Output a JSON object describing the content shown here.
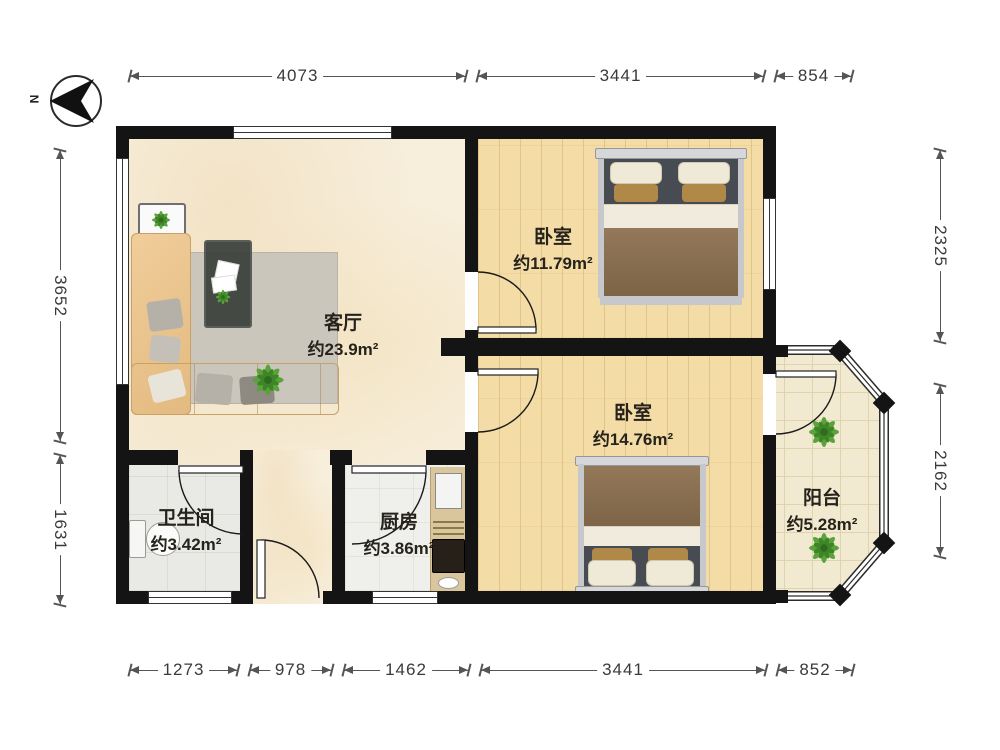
{
  "compass": {
    "label": "N"
  },
  "dimensions": {
    "top": [
      "4073",
      "3441",
      "854"
    ],
    "bottom": [
      "1273",
      "978",
      "1462",
      "3441",
      "852"
    ],
    "left": [
      "3652",
      "1631"
    ],
    "right": [
      "2325",
      "2162"
    ]
  },
  "rooms": {
    "living": {
      "name": "客厅",
      "area": "约23.9m²"
    },
    "bedroom_top": {
      "name": "卧室",
      "area": "约11.79m²"
    },
    "bedroom_bottom": {
      "name": "卧室",
      "area": "约14.76m²"
    },
    "bathroom": {
      "name": "卫生间",
      "area": "约3.42m²"
    },
    "kitchen": {
      "name": "厨房",
      "area": "约3.86m²"
    },
    "balcony": {
      "name": "阳台",
      "area": "约5.28m²"
    }
  },
  "colors": {
    "wall": "#141414",
    "wood_floor": "#f4dca6",
    "marble_floor": "#f7eedb",
    "tile_floor": "#e9e9e6",
    "balcony_tile": "#f2ead0",
    "duvet": "#8a6f4e",
    "sofa": "#eac48c",
    "plant": "#58a33a",
    "dimension_line": "#555555"
  }
}
